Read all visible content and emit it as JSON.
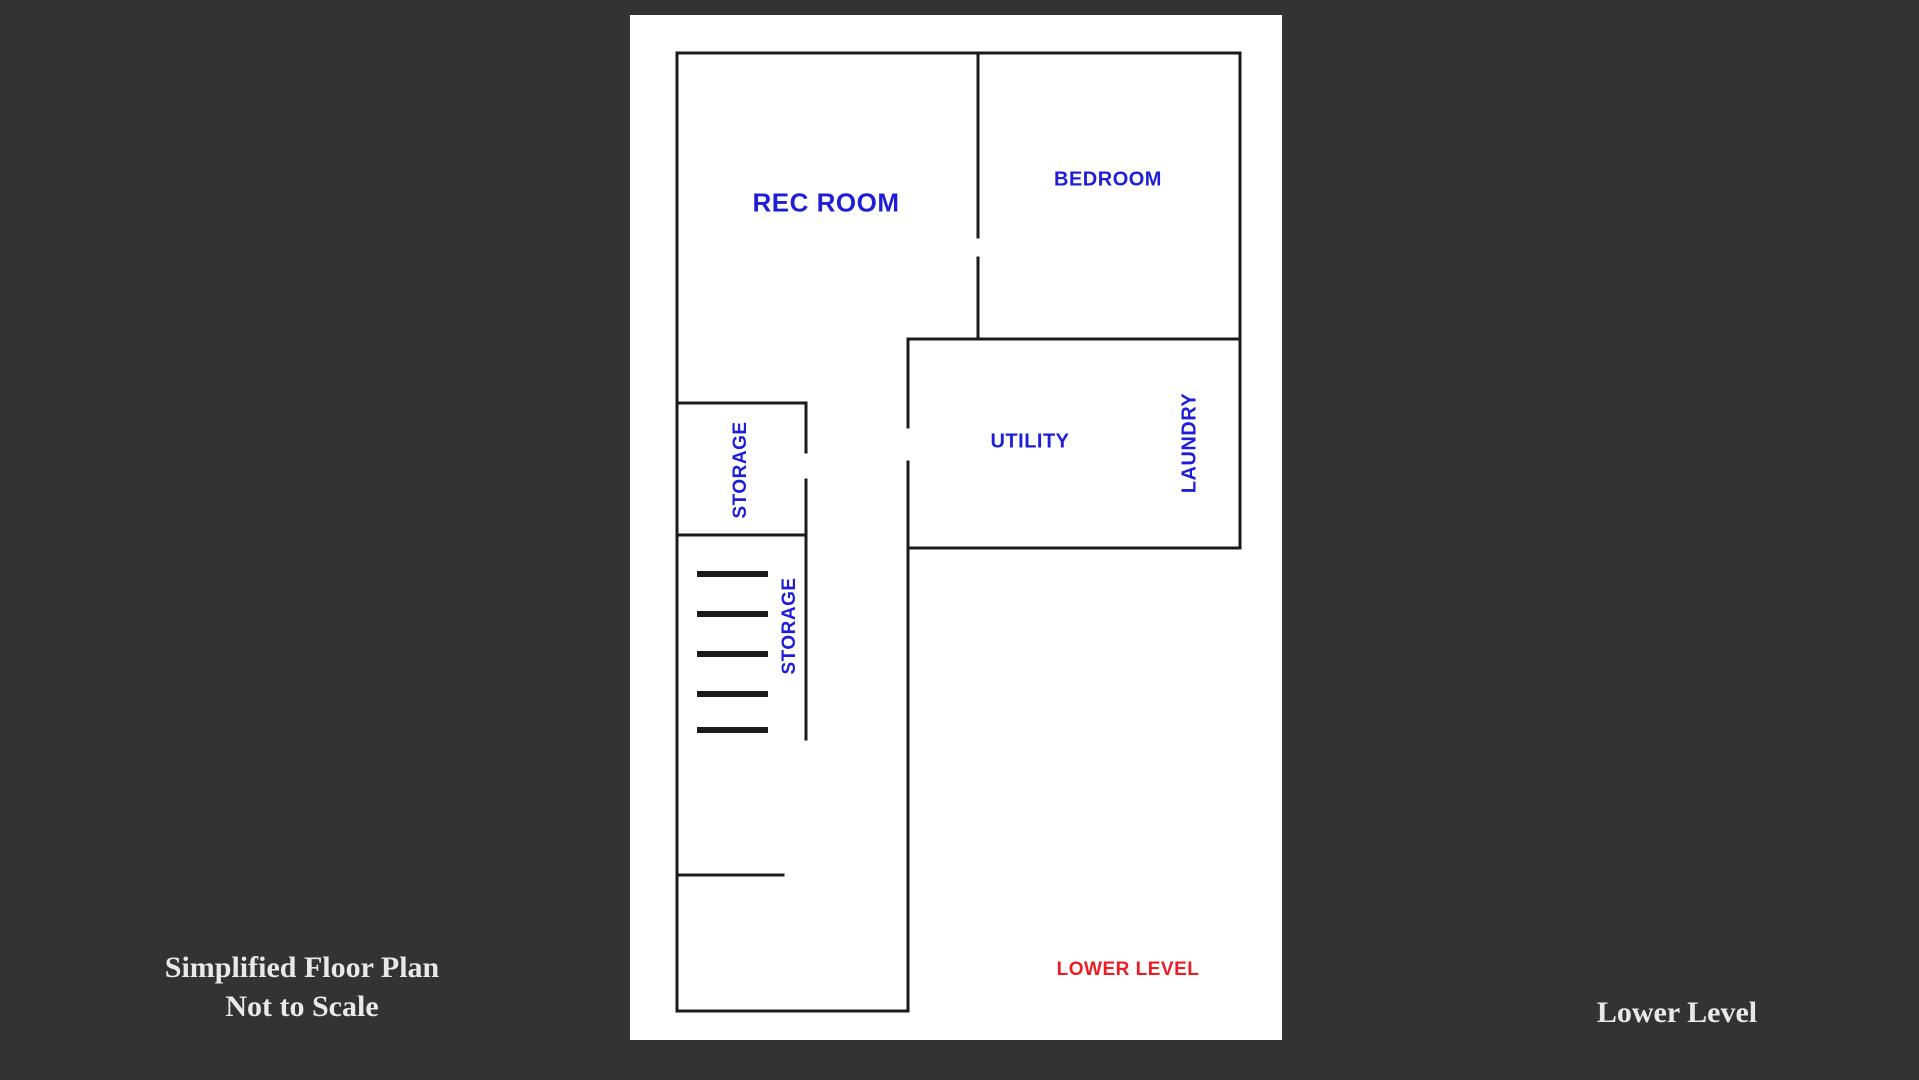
{
  "page": {
    "background_color": "#333333"
  },
  "panel": {
    "background_color": "#ffffff"
  },
  "plan": {
    "wall_color": "#1b1b1b",
    "room_label_color": "#1e1ed8",
    "level_label_color": "#ed1c24",
    "level_label": "LOWER LEVEL",
    "stairs_steps": 5,
    "rooms": [
      {
        "label": "REC ROOM"
      },
      {
        "label": "BEDROOM"
      },
      {
        "label": "STORAGE"
      },
      {
        "label": "UTILITY"
      },
      {
        "label": "LAUNDRY"
      },
      {
        "label": "STORAGE"
      }
    ]
  },
  "captions": {
    "text_color": "#e9e9e9",
    "left_line1": "Simplified Floor Plan",
    "left_line2": "Not to Scale",
    "right": "Lower Level"
  }
}
